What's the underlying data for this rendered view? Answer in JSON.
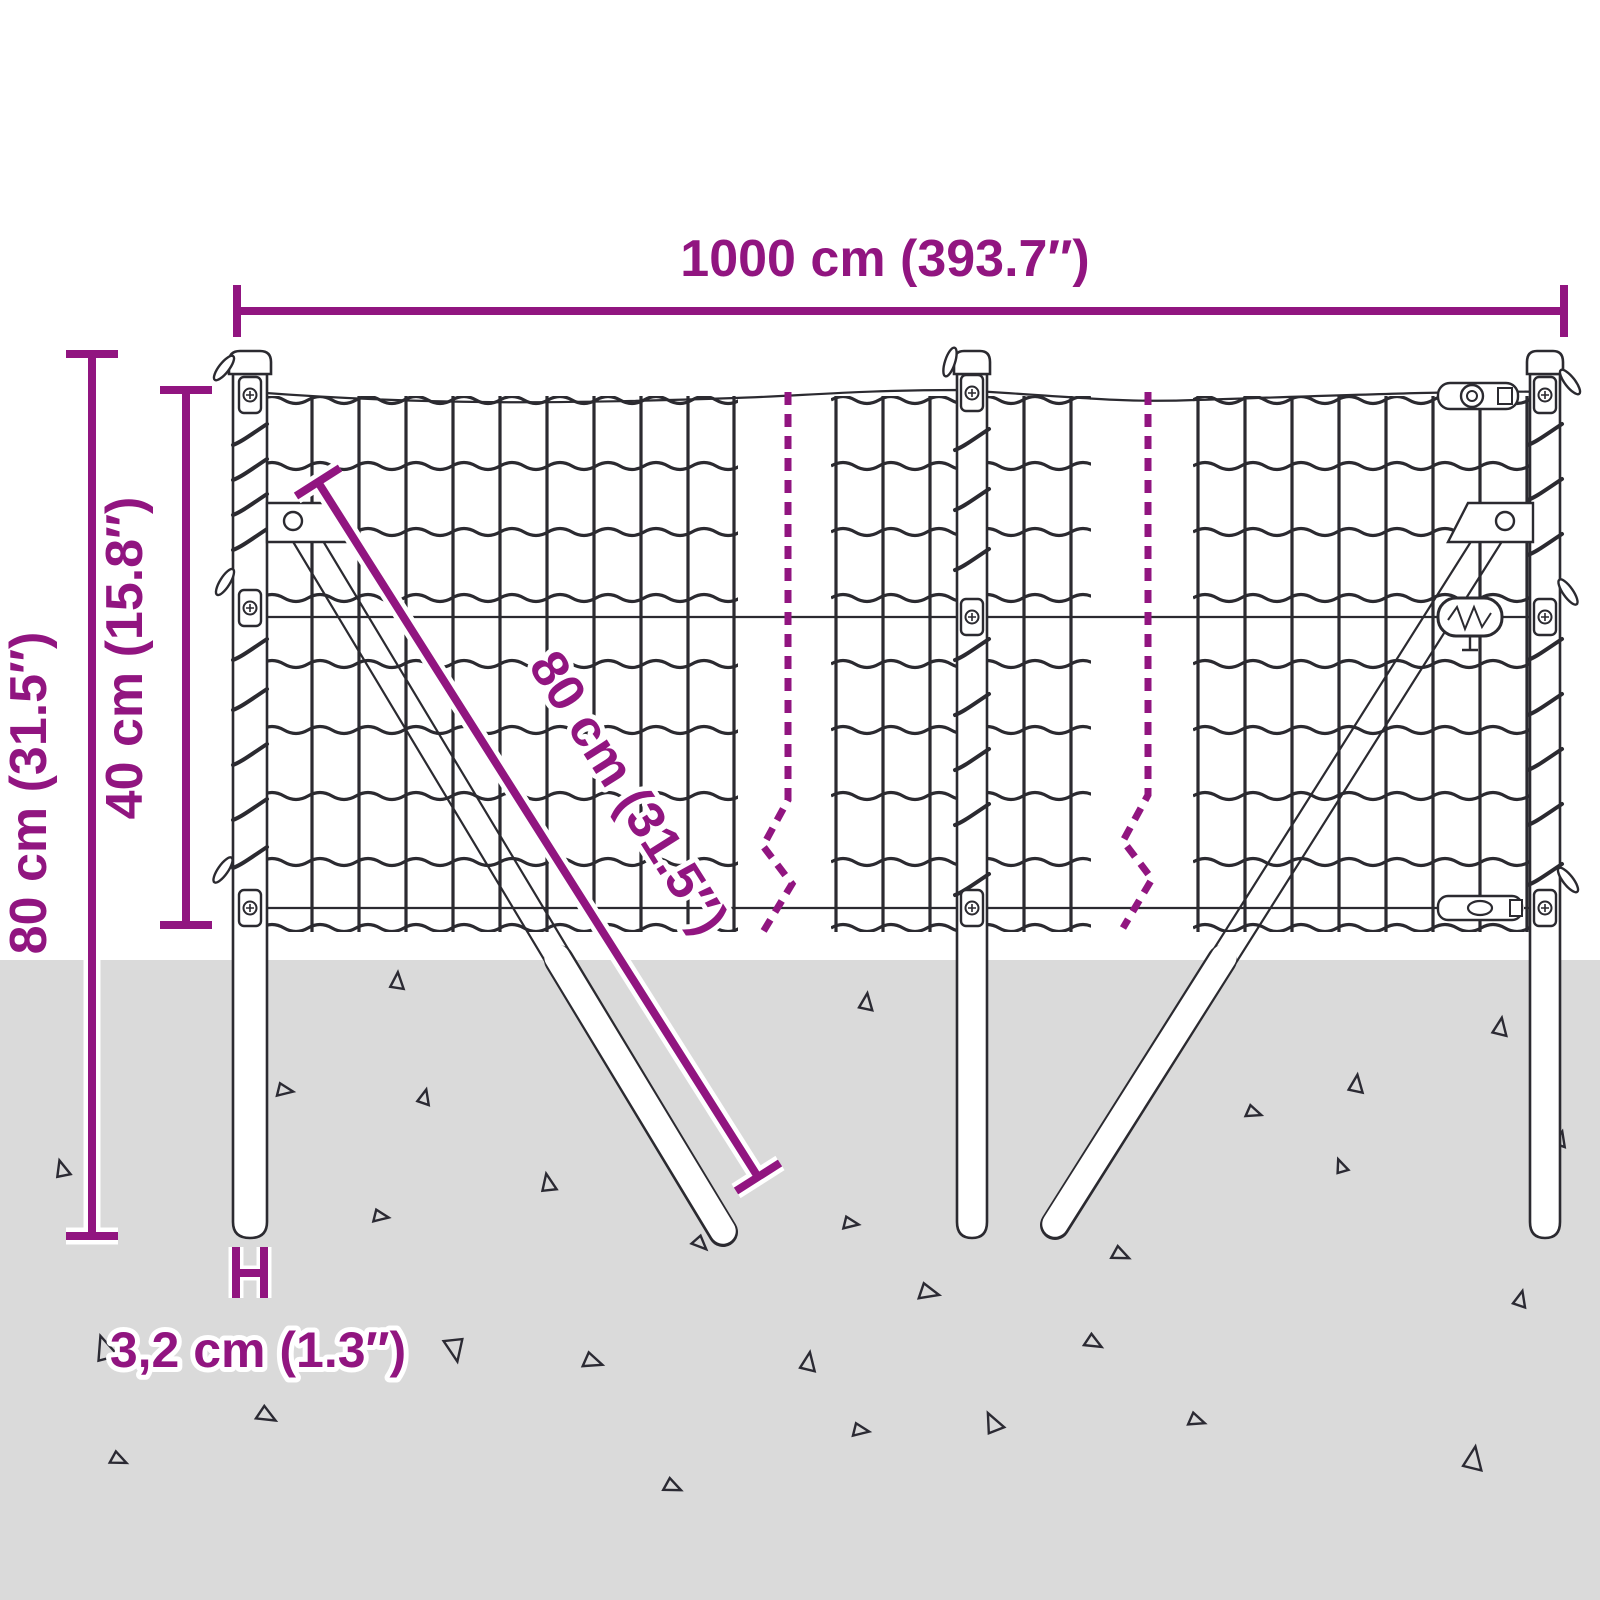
{
  "title": "Wire fence dimensions diagram",
  "diagram": {
    "dimensions": {
      "length": "1000 cm (393.7″)",
      "post_height": "80 cm (31.5″)",
      "mesh_height": "40 cm (15.8″)",
      "brace_length": "80 cm (31.5″)",
      "post_diameter": "3,2 cm (1.3″)"
    },
    "colors": {
      "dimension_accent": "#911580",
      "ground": "#DADADA",
      "line_art": "#2B2A30",
      "background": "#FFFFFF"
    }
  }
}
